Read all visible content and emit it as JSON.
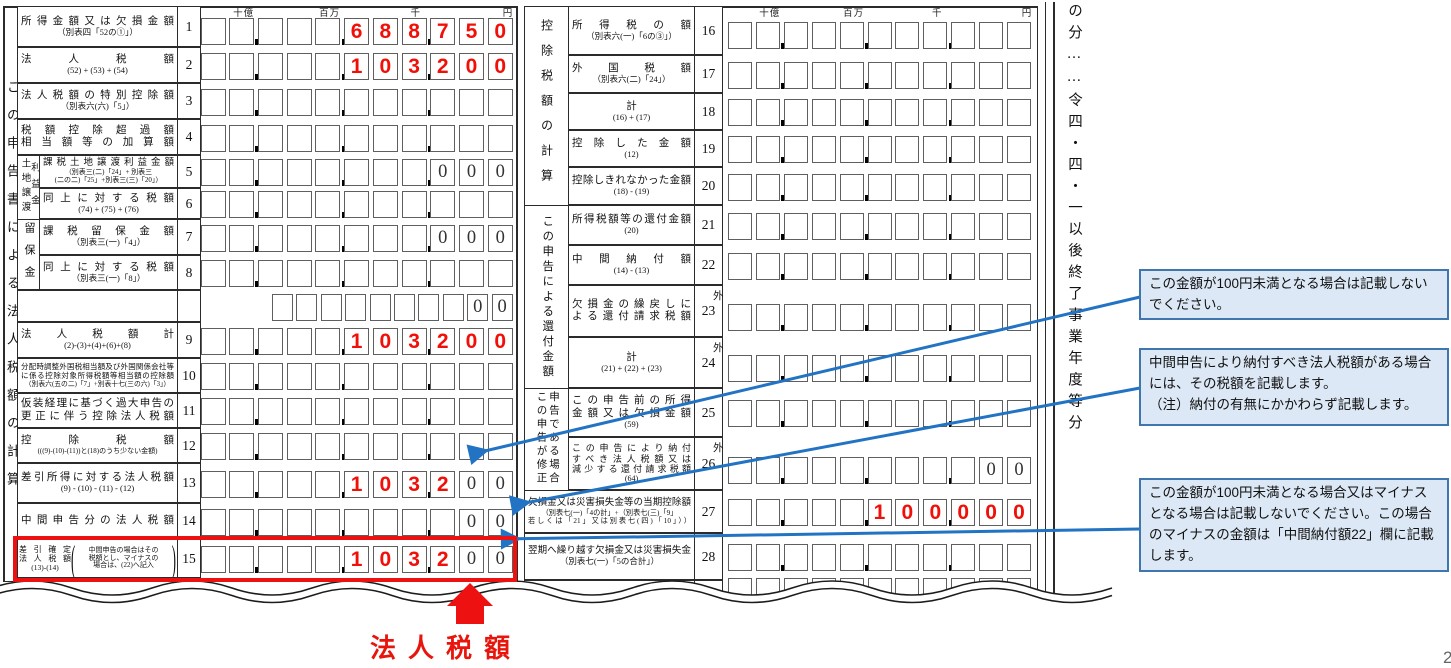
{
  "units": [
    "十億",
    "百万",
    "千",
    "円"
  ],
  "left_strip": "この申告書による法人税額の計算",
  "right_note": "の分……令四・四・一以後終了事業年度等分",
  "soto_marker": "外",
  "left_groups": {
    "land_transfer": [
      "土地譲渡",
      "利益金"
    ],
    "retained": "留保金"
  },
  "right_groups": {
    "deduction": "控除税額の計算",
    "refund": "この申告による還付金額",
    "amended": [
      "この申告が修正",
      "申告である場合"
    ]
  },
  "left_rows": [
    {
      "no": "1",
      "lines": [
        "所得金額又は欠損金額",
        "（別表四「52の①」）"
      ],
      "red": {
        "start": 5,
        "text": "688750"
      }
    },
    {
      "no": "2",
      "lines": [
        "法人税額",
        "(52) + (53) + (54)"
      ],
      "red": {
        "start": 5,
        "text": "103200"
      }
    },
    {
      "no": "3",
      "lines": [
        "法人税額の特別控除額",
        "（別表六(六)「5」）"
      ]
    },
    {
      "no": "4",
      "lines": [
        "税額控除超過額",
        "相当額等の加算額"
      ]
    },
    {
      "no": "5",
      "lines": [
        "課税土地譲渡利益金額",
        "（別表三(二)「24」+ 別表三",
        "(二の二)「25」+別表三(三)「20」）"
      ],
      "pre": {
        "start": 8,
        "text": "000"
      }
    },
    {
      "no": "6",
      "lines": [
        "同上に対する税額",
        "(74) + (75) + (76)"
      ]
    },
    {
      "no": "7",
      "lines": [
        "課税留保金額",
        "（別表三(一)「4」）"
      ],
      "pre": {
        "start": 8,
        "text": "000"
      }
    },
    {
      "no": "8",
      "lines": [
        "同上に対する税額",
        "（別表三(一)「8」）"
      ]
    },
    {
      "no": "",
      "lines": [],
      "pre": {
        "start": 8,
        "text": "00"
      }
    },
    {
      "no": "9",
      "lines": [
        "法人税額計",
        "(2)-(3)+(4)+(6)+(8)"
      ],
      "red": {
        "start": 5,
        "text": "103200"
      }
    },
    {
      "no": "10",
      "lines": [
        "分配時調整外国税相当額及び外国関係会社等",
        "に係る控除対象所得税額等相当額の控除額",
        "（別表六(五の二)「7」+別表十七(三の六)「3」）"
      ]
    },
    {
      "no": "11",
      "lines": [
        "仮装経理に基づく過大申告の",
        "更正に伴う控除法人税額"
      ]
    },
    {
      "no": "12",
      "lines": [
        "控除税額",
        "(((9)-(10)-(11))と(18)のうち少ない金額)"
      ]
    },
    {
      "no": "13",
      "lines": [
        "差引所得に対する法人税額",
        "(9) - (10) - (11) - (12)"
      ],
      "red": {
        "start": 5,
        "text": "1032"
      },
      "pre": {
        "start": 9,
        "text": "00"
      }
    },
    {
      "no": "14",
      "lines": [
        "中間申告分の法人税額"
      ],
      "pre": {
        "start": 9,
        "text": "00"
      }
    },
    {
      "no": "15",
      "lines": [
        "差引確定",
        "法人税額",
        "(13)-(14)"
      ],
      "paren": [
        "中間申告の場合はその",
        "税額とし、マイナスの",
        "場合は、(22)へ記入"
      ],
      "red": {
        "start": 5,
        "text": "1032"
      },
      "pre": {
        "start": 9,
        "text": "00"
      }
    }
  ],
  "right_rows": [
    {
      "no": "16",
      "lines": [
        "所得税の額",
        "（別表六(一)「6の③」）"
      ]
    },
    {
      "no": "17",
      "lines": [
        "外国税額",
        "（別表六(二)「24」）"
      ]
    },
    {
      "no": "18",
      "lines": [
        "計",
        "(16) + (17)"
      ]
    },
    {
      "no": "19",
      "lines": [
        "控除した金額",
        "(12)"
      ]
    },
    {
      "no": "20",
      "lines": [
        "控除しきれなかった金額",
        "(18) - (19)"
      ]
    },
    {
      "no": "21",
      "lines": [
        "所得税額等の還付金額",
        "(20)"
      ]
    },
    {
      "no": "22",
      "lines": [
        "中間納付額",
        "(14) - (13)"
      ]
    },
    {
      "no": "23",
      "lines": [
        "欠損金の繰戻しに",
        "よる還付請求税額"
      ],
      "soto": true
    },
    {
      "no": "24",
      "lines": [
        "計",
        "(21) + (22) + (23)"
      ],
      "soto": true
    },
    {
      "no": "25",
      "lines": [
        "この申告前の所得",
        "金額又は欠損金額",
        "(59)"
      ]
    },
    {
      "no": "26",
      "lines": [
        "この申告により納付",
        "すべき法人税額又は",
        "減少する還付請求税額",
        "(64)"
      ],
      "soto": true,
      "pre": {
        "start": 9,
        "text": "00"
      }
    },
    {
      "no": "27",
      "lines": [
        "欠損金又は災害損失金等の当期控除額",
        "（別表七(一)「4の計」+（別表七(三)「9」",
        "若しくは「21」又は別表七(四)「10」））"
      ],
      "red": {
        "start": 5,
        "text": "100000"
      }
    },
    {
      "no": "28",
      "lines": [
        "翌期へ繰り越す欠損金又は災害損失金",
        "（別表七(一)「5の合計」）"
      ]
    },
    {
      "no": "",
      "lines": []
    }
  ],
  "callouts": [
    {
      "lines": [
        "この金額が100円未満となる場合は記載しないでください。"
      ]
    },
    {
      "lines": [
        "中間申告により納付すべき法人税額がある場合には、その税額を記載します。",
        "（注）納付の有無にかかわらず記載します。"
      ]
    },
    {
      "lines": [
        "この金額が100円未満となる場合又はマイナスとなる場合は記載しないでください。この場合のマイナスの金額は「中間納付額22」欄に記載します。"
      ]
    }
  ],
  "red_annotation": "法人税額",
  "page_number": "2",
  "colors": {
    "accent_red": "#ee1111",
    "digit_red": "#f01008",
    "arrow_blue": "#2273c3",
    "callout_bg": "#dce8f5",
    "callout_border": "#3f76ad"
  }
}
